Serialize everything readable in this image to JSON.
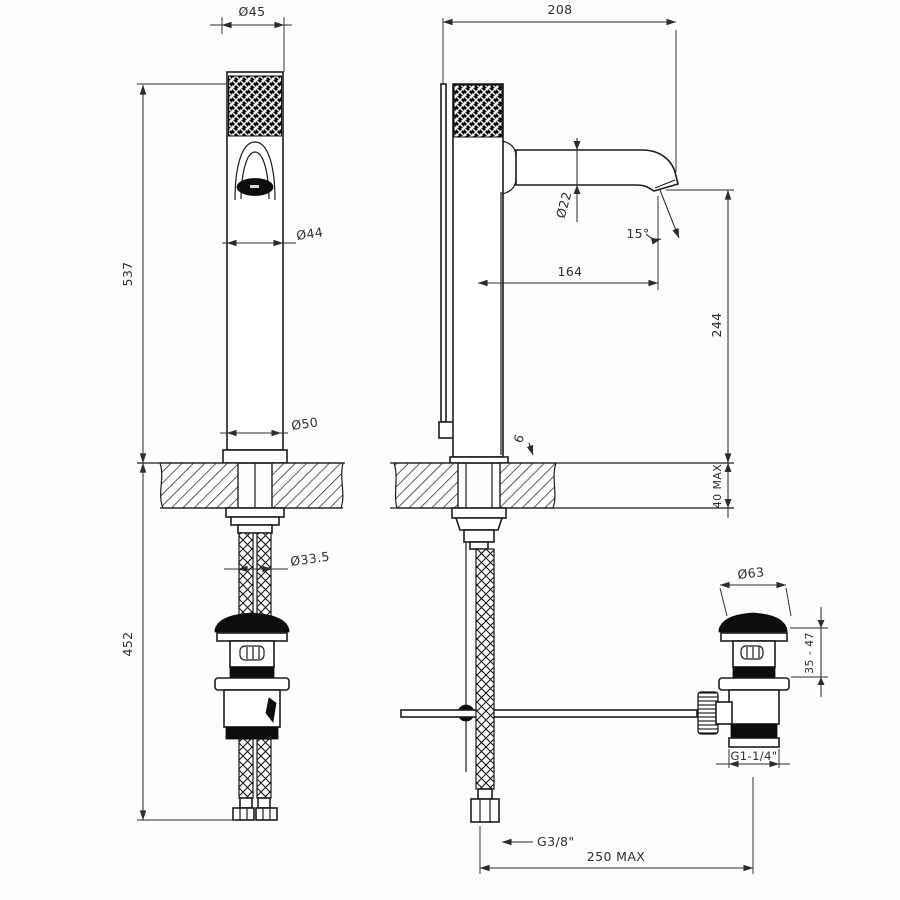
{
  "drawing_type": "faucet technical dimension drawing",
  "colors": {
    "line": "#1c1c1c",
    "background": "#fdfdfd",
    "dark_fill": "#0d0d0d"
  },
  "labels": {
    "front": {
      "cap_d": "Ø45",
      "height": "537",
      "body_d": "Ø44",
      "base_d": "Ø50",
      "hose_d": "Ø33.5",
      "below": "452"
    },
    "side": {
      "reach": "208",
      "outlet_d": "Ø22",
      "angle": "15°",
      "projection": "164",
      "outlet_h": "244",
      "deck_max": "40 MAX",
      "plate_h": "6",
      "hose_thread": "G3/8\"",
      "hose_reach": "250 MAX"
    },
    "drain": {
      "cap_d": "Ø63",
      "clamp": "35 - 47",
      "thread": "G1-1/4\""
    }
  }
}
